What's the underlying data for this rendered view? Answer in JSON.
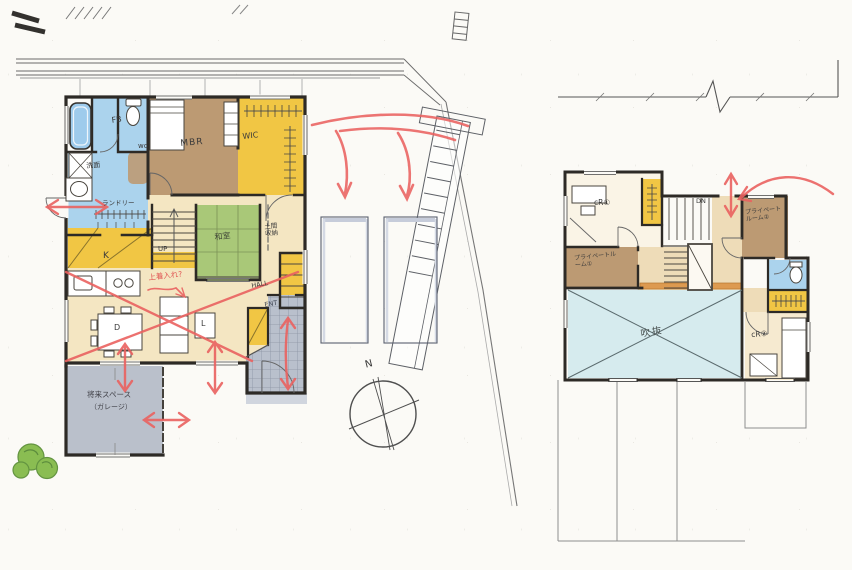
{
  "palette": {
    "paper": "#fbfaf6",
    "wall_ink": "#2d2a26",
    "marker_red": "#ea6260",
    "sanitary_blue": "#abd3ed",
    "closet_yellow": "#f1c644",
    "bedroom_brown": "#bc9a73",
    "floor_beige": "#f4e6c2",
    "tatami_green": "#a9c878",
    "entrance_gray": "#b9c0cc",
    "atrium_blue": "#d6ebee"
  },
  "site": {
    "compass_north": "N"
  },
  "floor1": {
    "labels": {
      "bath": "FB",
      "toilet": "wc",
      "washroom": "洗面",
      "laundry": "ランドリー",
      "master_bedroom": "MBR",
      "walk_in_closet": "WIC",
      "stairs_up": "UP",
      "japanese_room": "和室",
      "doma_storage": "土間収納",
      "kitchen": "K",
      "dining": "D",
      "living": "L",
      "hall": "HALL",
      "entrance": "ENT",
      "future_space": "将来スペース",
      "future_space_sub": "（ガレージ）",
      "red_note": "上着入れ?"
    }
  },
  "floor2": {
    "labels": {
      "kids_room_1": "cR①",
      "stairs_down": "DN",
      "private_room_1": "プライベートルーム①",
      "private_room_2": "プライベートルーム②",
      "kids_room_2": "cR②",
      "atrium": "吹抜"
    }
  }
}
